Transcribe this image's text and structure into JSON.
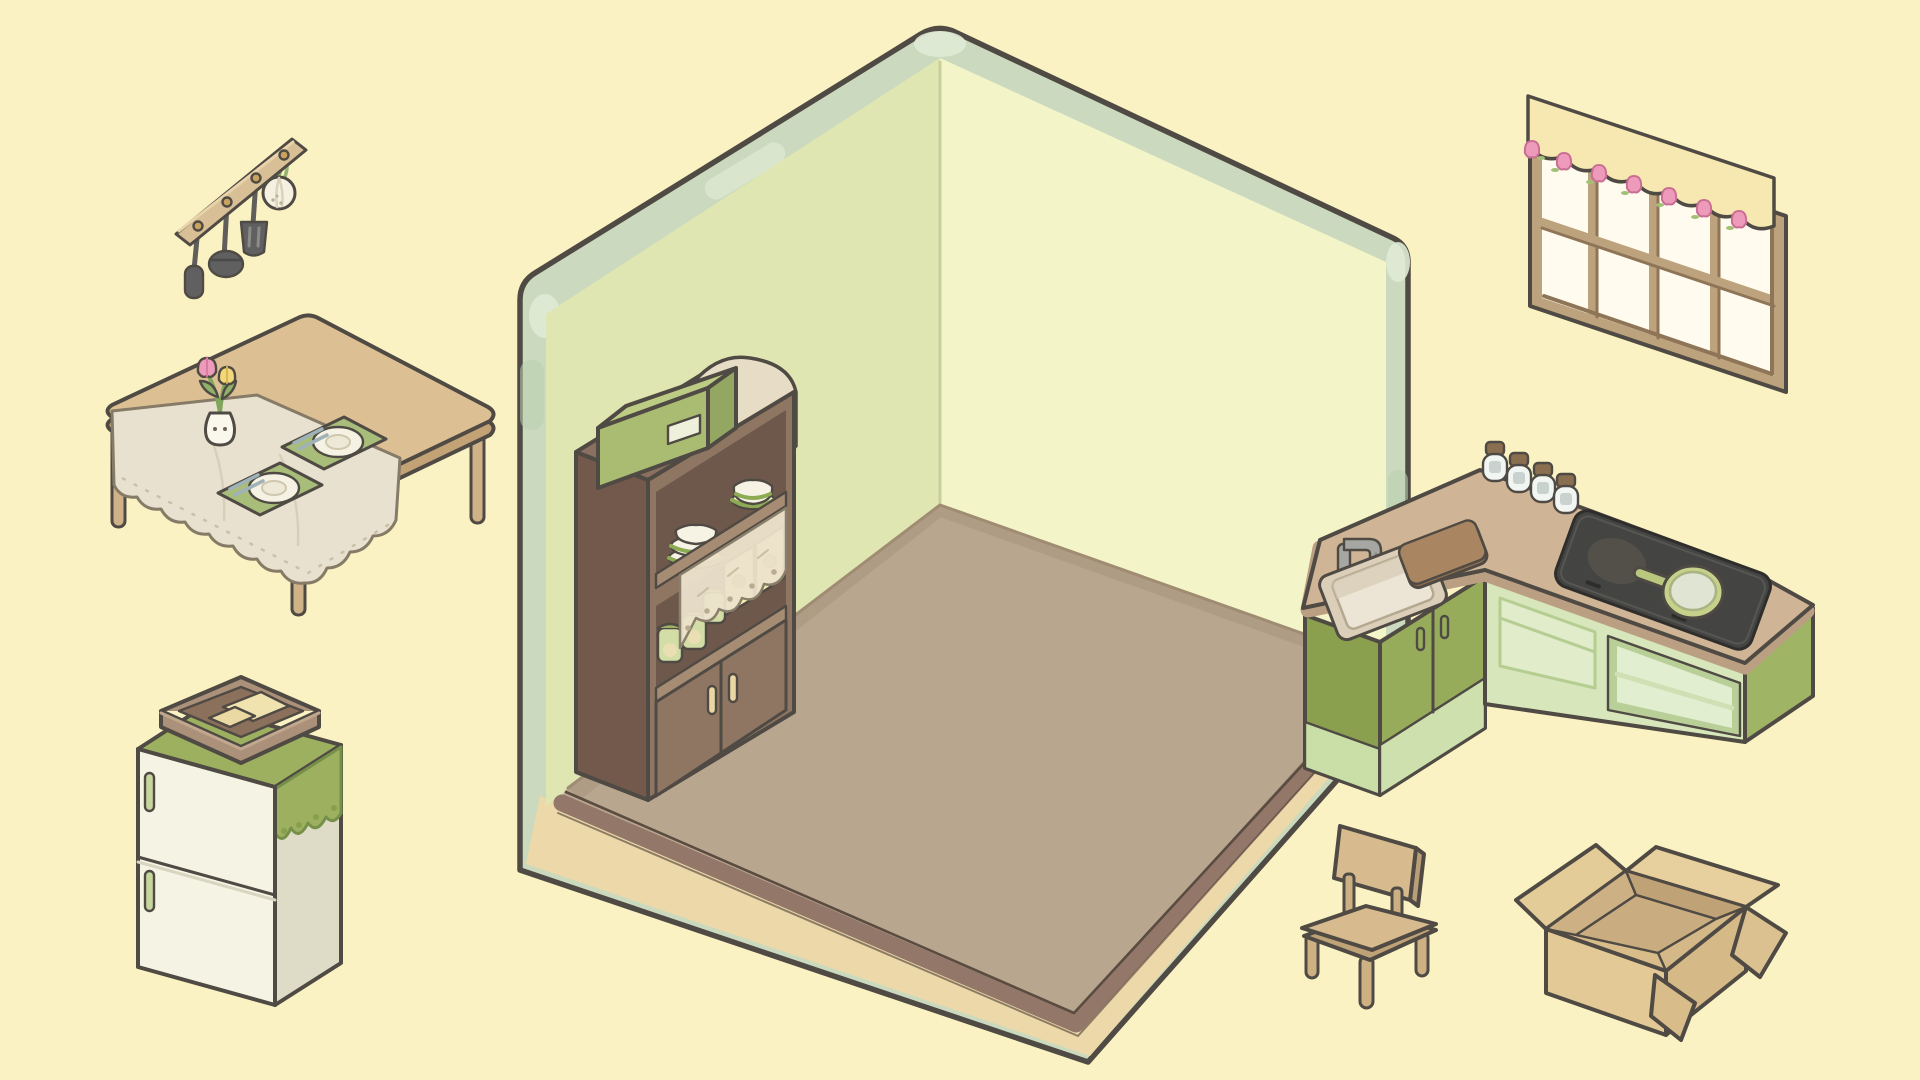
{
  "app": {
    "name": "cozy-room-decorator",
    "view": "kitchen-room-decoration"
  },
  "palette": {
    "background": "#fbf2c3",
    "outline": "#4f4a43",
    "wall_left": "#e0e6b2",
    "wall_right": "#f3f5c9",
    "wall_trim": "#cbdabe",
    "floor": "#b9a68f",
    "floor_edge": "#93786a",
    "floor_base": "#ecd8a8",
    "wood": "#d7bb8f",
    "cabinet_green": "#97ac5b",
    "cabinet_green_light": "#d7e6bb",
    "cloth_green": "#9cb05f",
    "countertop": "#cfb595",
    "cardboard": "#e3cc98",
    "tulip_pink": "#ee9aba"
  },
  "room": {
    "name": "empty kitchen room",
    "walls": "2 pale green walls with mint trim",
    "floor": "tan floor on cream base"
  },
  "items": [
    {
      "id": "utensil-rack",
      "name": "Hanging utensil rack",
      "x": 168,
      "y": 122,
      "w": 190,
      "h": 180,
      "details": "wood rail with 4 hooks: spatula, ladle, slotted turner, garlic bulb"
    },
    {
      "id": "dining-table",
      "name": "Dining table",
      "x": 100,
      "y": 295,
      "w": 385,
      "h": 360,
      "details": "lace tablecloth, two green placemats with plates and chopsticks, bunny vase with pink and yellow tulips"
    },
    {
      "id": "refrigerator",
      "name": "Refrigerator",
      "x": 103,
      "y": 665,
      "w": 250,
      "h": 350,
      "details": "cream two-door fridge, green doily cloth, wicker basket with tofu on top"
    },
    {
      "id": "cupboard",
      "name": "Kitchen cupboard",
      "x": 568,
      "y": 330,
      "w": 240,
      "h": 500,
      "details": "stacked plates and bowls, jars, recipe boxes, lace valance, green box and cloth on top"
    },
    {
      "id": "window",
      "name": "Window with valance",
      "x": 1522,
      "y": 88,
      "w": 275,
      "h": 315,
      "details": "eight-pane wood window, scalloped curtain with pink tulips"
    },
    {
      "id": "kitchen-counter",
      "name": "L-shaped kitchen counter",
      "x": 1295,
      "y": 370,
      "w": 530,
      "h": 420,
      "details": "sink with faucet, cutting board, four spice jars, induction cooktop with frying pan, green cabinets"
    },
    {
      "id": "chair",
      "name": "Wooden chair",
      "x": 1288,
      "y": 818,
      "w": 160,
      "h": 200,
      "details": "simple tan wood chair"
    },
    {
      "id": "cardboard-box",
      "name": "Open cardboard box",
      "x": 1508,
      "y": 843,
      "w": 300,
      "h": 210,
      "details": "empty open moving box"
    }
  ]
}
